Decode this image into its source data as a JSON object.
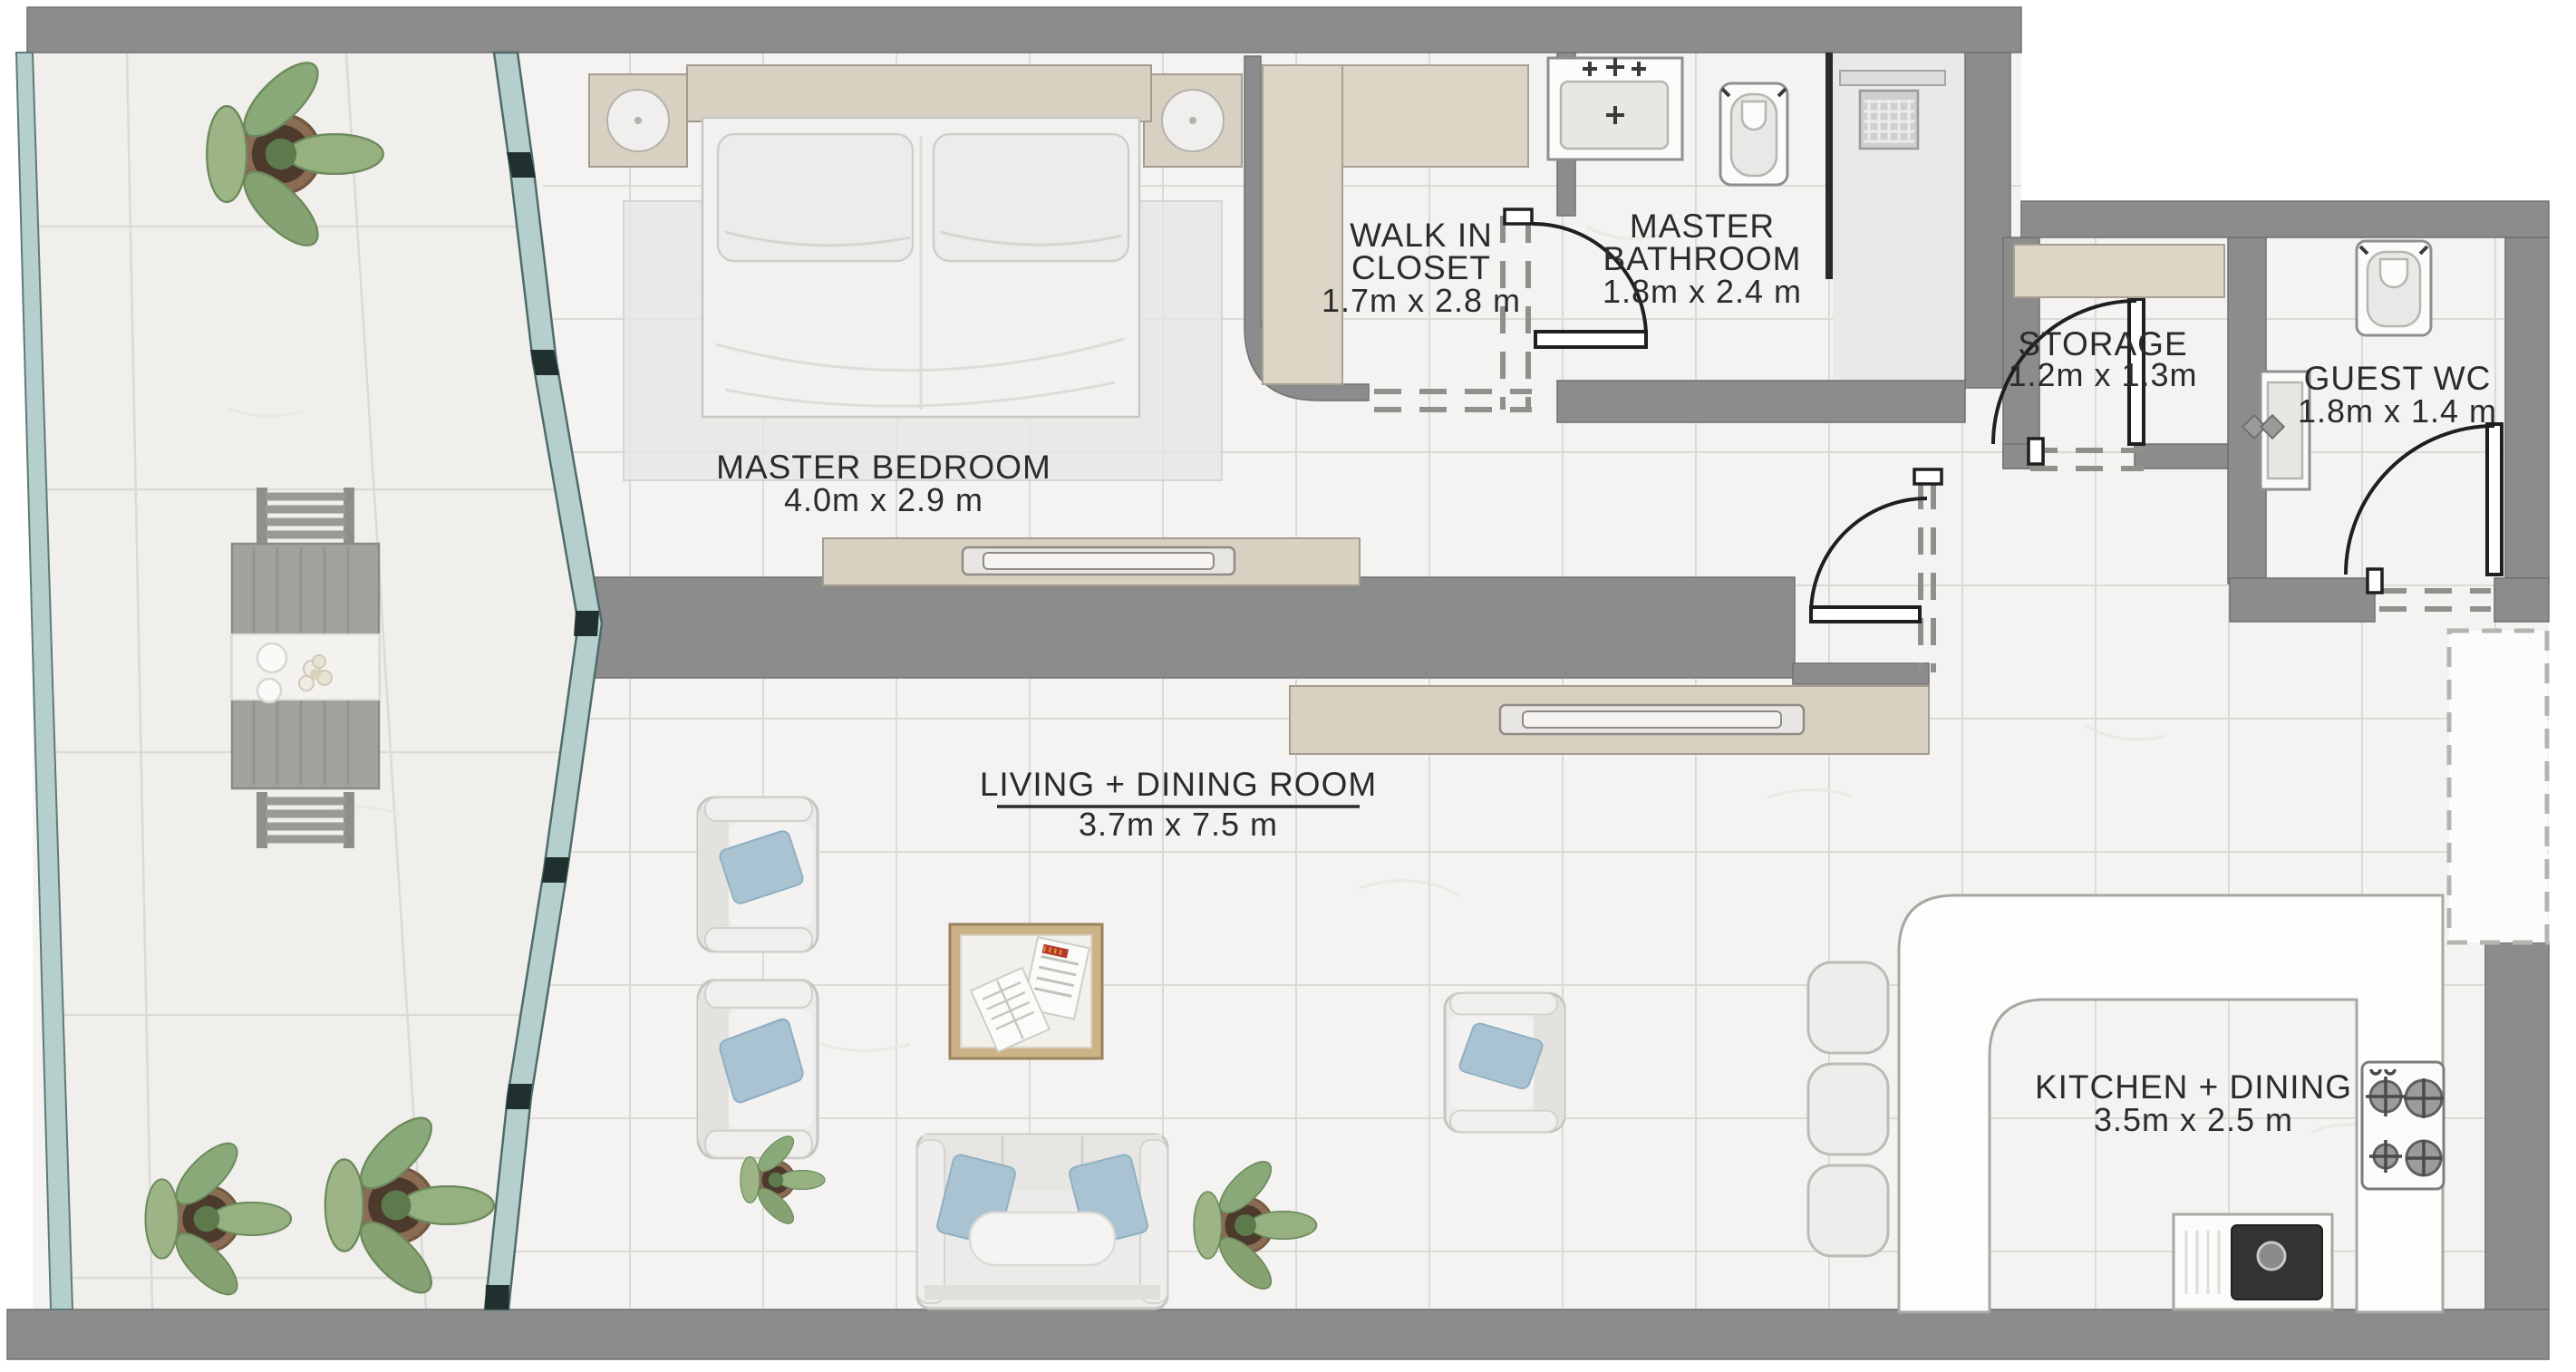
{
  "plan": {
    "rooms": {
      "master_bedroom": {
        "name": "MASTER BEDROOM",
        "dims": "4.0m x 2.9 m"
      },
      "walk_in_closet": {
        "line1": "WALK IN",
        "line2": "CLOSET",
        "dims": "1.7m x 2.8 m"
      },
      "master_bathroom": {
        "line1": "MASTER",
        "line2": "BATHROOM",
        "dims": "1.8m x 2.4 m"
      },
      "storage": {
        "name": "STORAGE",
        "dims": "1.2m x 1.3m"
      },
      "guest_wc": {
        "name": "GUEST WC",
        "dims": "1.8m x 1.4 m"
      },
      "living_dining": {
        "name": "LIVING + DINING ROOM",
        "dims": "3.7m x 7.5 m"
      },
      "kitchen_dining": {
        "name": "KITCHEN + DINING",
        "dims": "3.5m x 2.5 m"
      }
    },
    "colors": {
      "wall_gray": "#8c8c8c",
      "glass_teal": "#b5cfcd",
      "mullion_dark": "#20302e",
      "floor_marble": "#f4f3f1",
      "furniture_beige": "#d8d1c2",
      "accent_blue": "#a9c3d2",
      "plant_green": "#93ac82",
      "label_text": "#2c2b29"
    }
  }
}
